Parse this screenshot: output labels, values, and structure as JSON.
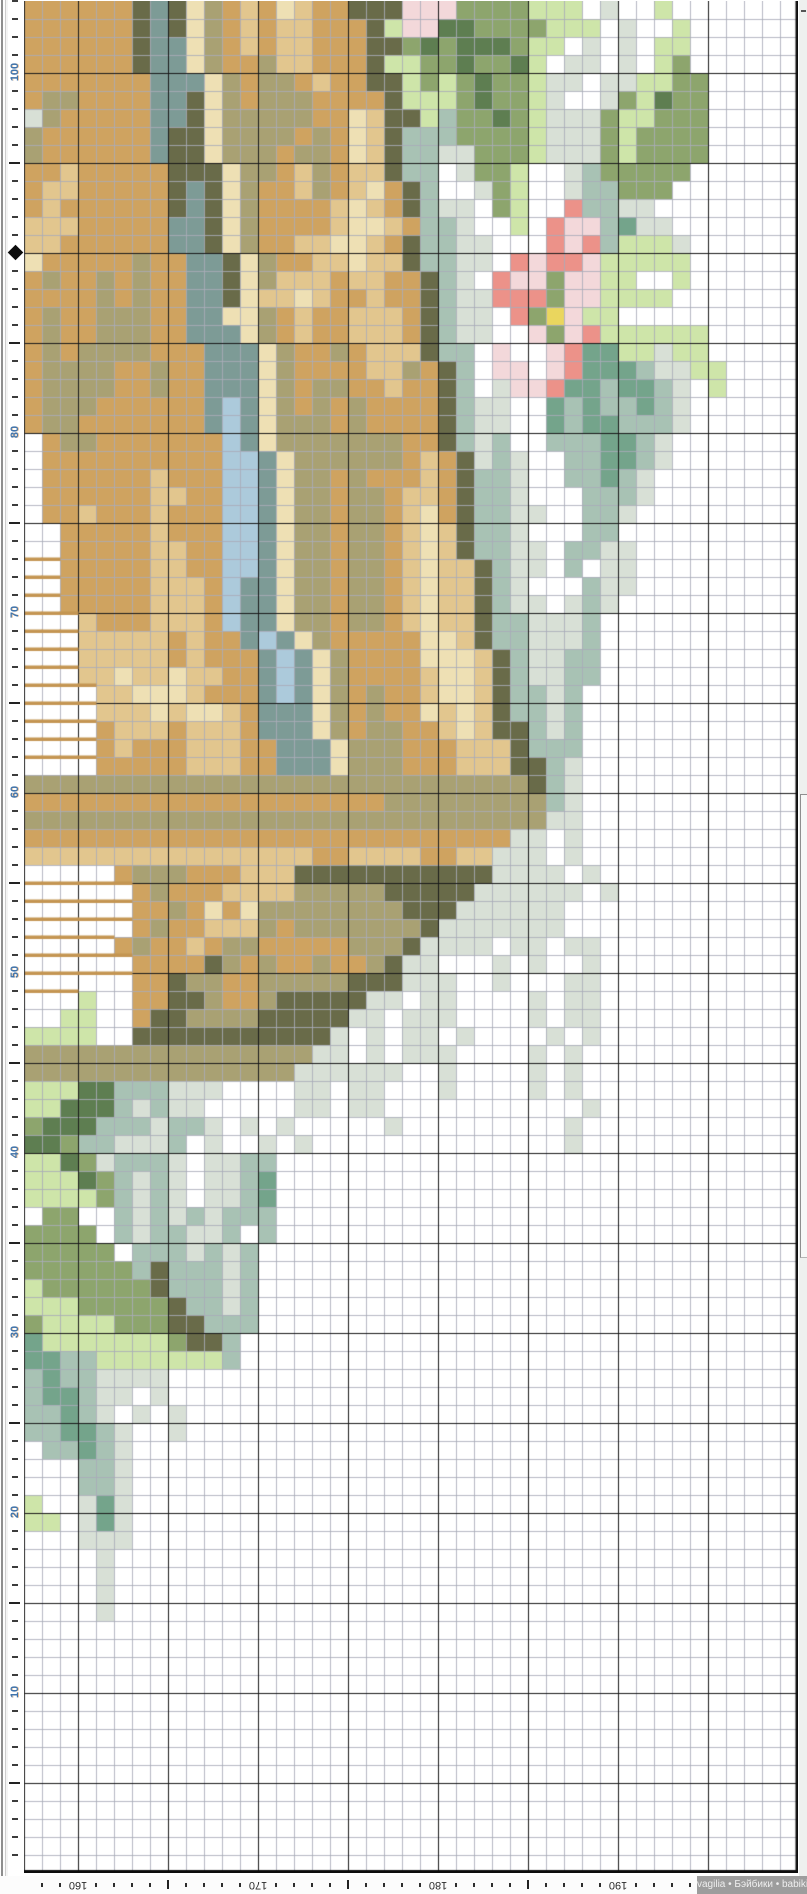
{
  "pattern": {
    "origin_x": 24,
    "origin_y": 1,
    "cell": 18,
    "cols": 43,
    "rows": 104,
    "first_col_stitch": 157,
    "bottom_row_stitch": 0,
    "grid_minor": "#a9acb9",
    "grid_major": "#1a1a1a",
    "edge_color": "#0d0d0d",
    "bar_color": "#c49552",
    "palette": {
      ".": "",
      "T": "#cfa360",
      "t": "#e2c68e",
      "C": "#eee0b4",
      "K": "#a9a173",
      "O": "#696b49",
      "B": "#7d9b96",
      "L": "#accadb",
      "F": "#5e7e51",
      "G": "#8da56d",
      "g": "#cee5a9",
      "E": "#d8e0d6",
      "M": "#74a48b",
      "m": "#a8c2b4",
      "q": "#f3d8da",
      "R": "#ec9289",
      "Y": "#ead65e",
      "N": "bar"
    },
    "rows_data": [
      "TTTTTTOBOCKTtTCtTTOOOqqqGGGGggg.E..g.......",
      "TTTTTTOBOCKTtTttTTTOgqqFFGGGGggg.E..g......",
      "TTTTTTOBBCKTtTttTTTOOGFGFFFGgg.E.E.gg......",
      "TTTTTTOBBCKTTKttTTTOggGGFGGFg.EE.E.gG......",
      "TTTTTTTBBBCKTKKTtTTOOgGgGFGGgEE.EEggGG.....",
      "TKKTTTTBBOCKTKKKTTTTOgggGFGGgE..EGgFGG.....",
      "EKTTTTTBBOCKKKKKTTCtOOgmGGFGgEEEGggGGG.....",
      "KTTTTTTBOOCKKKKTKTCtOmmmGGGGgEEEGgGGGG.....",
      "KTTTTTTBOOCKKKTKKTCtOmmEEGGGgEEEGgGGGG.....",
      "TTtTTTTTOOOCKKTtKTttOmm.EGGg..EmGGGGG......",
      "TttTTTTTOBOCKTTtKTtCTOm..EGg..EmmGGG.......",
      "TtTTTTTTOBOCKTTTTtCtTOmEE.Gg..RmmEE........",
      "tttTTTTTBBOCKTTTTtCCtTmmE..g.RqqmMEE.......",
      "ttTTTTTTBBOCKTTttCCtTOmmEE...RqRmgggE......",
      "CTTTTTKTTBBOCKTTttCttOmmEE.RqRRqggggg......",
      "TKTTKTKTTBBOCKtttTttTTOmE.RqqGqqgg..g......",
      "TTTTKTKTTBBOCttCtTTtTTOmEERRRGqqgggg.......",
      "TKTTKKKTTBBCCKTtTTtttTOmEE.RGYqgg..........",
      "TKTTKKKTTBBBCKTtTTtttTOmEE..qGqRgggggg.....",
      "TKTKKKKTTTBBBCKTTKTtttOmm.q..qRMMggEgg.....",
      "TKKKKTTKTTBBBCKTTTTttKTOm.qq.qRMMMmEEgg....",
      "TKKKKTTKTTBBBCKTKKTTtTTOm.EqqRMMmMMmE.g....",
      "TKKKTTTTTTBLBCKTKTKTTTTOmEE..MmMmmMmE......",
      "TKKTTTTTTTBLBCKKKTKTTTTOmEE..MmMMmmmE......",
      ".TKKTTTTTTTLBCKKKKKKKTTOmEm..mmmMMmE.......",
      ".TTTTTTTTTTLLBCKKKKKKTtTOEmE..mmMMmE.......",
      ".TTTTTTtTTTLLBCKKTKTTTtTOmmE..mmMmE........",
      ".TTTTTTttTTLLBCKKTKKTttTOmmE...mmmE........",
      ".TTtTTTtTTTLLBCKKTKKTtCTOmmEE..mmE.........",
      "..TTTTTtTTTLLBCKKTKKTtCtOmmE...mm..........",
      "..TTTTTttTTLLBCKKTKKTtCtOmmEE.mmEE.........",
      "NNTTTTTttTTLLBCKKTKKTtCttOmEE.m.EE.........",
      "NNTTTTTtttTLBBCKKTKKTtCttOmE...mEE.........",
      "NNTTTTTtttTLBBCKKTKKTtCttOmEE.EmE..........",
      "NNNtTTTtttTLBBCKKTKKTtCttOmmEEEm...........",
      "NNNtttttTtTTBLBCKTTTTTCCtOmmEEEm...........",
      "NNNtttttTtTTTBLBCKTTTTCCCtOmEEmm...........",
      "NNNttCttCttTTBLBCKTTTTtCCtOmEEmm...........",
      "NNNNttCCCtTTTBLBCKTKTTtCCtOmmEm............",
      "NNNNtttCtCCtTBBBCKTKTTCtCtOmmEm............",
      "NNNNTtttTtttTBBBCKTKKTTtCtOOmEm............",
      "NNNNTtTTTtttTTBBBCKKKTTTtttOmmm............",
      "NNNNTTTTTtttTTBBBCKKKTTTtttOOmE............",
      "KKKKKKKKKKKKKKKKKKKKKKKKKKKKOmE............",
      "TTTTTTTTTTTTTTTTTTTTKKKKKKKKKmE............",
      "KKKKKKKKKKKKKKKKKKKKKKKKKKKKKEE............",
      "TTTTTTTTTTTTTTTTTTTTTTTTTTTEE.E............",
      "ttttttttttttttttTTttttTTttEEE.E............",
      ".....TKKKTTTtttOOOOOOOOOOOEEEE.E...........",
      "NNNNNNTKTTTttttKKKKKOOOOOEEEEEE.E..........",
      "NNNNNNTTKTCTCKKKKKKKKOOOEEEEEE.............",
      "NNNNNNTKTTtttKTKKKKKKKOEEEEEEE.............",
      "NNNNNTKTTtTKKTTTTTKKKOEEEE.EE.EE...........",
      "NNNNNNTTTTOKTKTTKTTKOEE...E.E..E...........",
      "NNNNNNTTOKKTTKKKKKOOOEEE..E...EE...........",
      "NNNg..TTOOKTTKOOOOOEE.EE....E.EE...........",
      "..gg..TOOKKKKOOOOOEE.EEE....E.EE...........",
      "gggg..OOOOOOOOOOOE.E.EE.E....E.E...........",
      "KKKKKKKKKKKKKKKKEE.E.EEE....E.E............",
      "KKKKKKKKKKKKKKKEEEEEE..E....E.E............",
      "gggFFmmmEEE....EE.EE...E....E.E............",
      "ggFFFmEmEE.....EE.EE...........E...........",
      "GFFFmmmEmmE.E.E.....E.........E............",
      "FFGmmEEEm.E..E.E..............E............",
      "ggFGEmmmE.EEmm.............................",
      "gggFGmEmE.EEmM.............................",
      "ggggGmEmE.EEmM.............................",
      ".GG..mEmEmEmmm.............................",
      "GGGG.mEmmEEm.m.............................",
      "GGGGG.mmmEmEm..............................",
      "GGGGGGmOmmmEm..............................",
      "gGGGGGGOmmmEm..............................",
      "gggGGGGGOmmEm..............................",
      "GggggGGGOOmmm..............................",
      "MgggggggGOOm...............................",
      "MMmmgggggggm...............................",
      "mMmmEEEE...................................",
      "mMMmEE.E...................................",
      "mmMmE.E.E..................................",
      "mmMMmE..E..................................",
      ".mmMmE.....................................",
      "...mmE.....................................",
      "...mmE.....................................",
      "g..EME.....................................",
      "gg.EME.....................................",
      "...EEE.....................................",
      "....E......................................",
      "....E......................................",
      "....E......................................",
      "....E......................................",
      "...........................................",
      "...........................................",
      "...........................................",
      "...........................................",
      "...........................................",
      "...........................................",
      "...........................................",
      "...........................................",
      "...........................................",
      "...........................................",
      "...........................................",
      "...........................................",
      "...........................................",
      "..........................................."
    ]
  },
  "left_ruler": {
    "labels": [
      100,
      80,
      70,
      60,
      50,
      40,
      30,
      20,
      10
    ],
    "marker_stitch": 90,
    "number_color": "#3f74ad"
  },
  "bottom_ruler": {
    "labels": [
      160,
      170,
      180,
      190,
      200
    ]
  },
  "watermark": {
    "text": "vagilia • Бэйбики • babiki",
    "bg": "#9d9d9d",
    "color": "#efefef"
  }
}
